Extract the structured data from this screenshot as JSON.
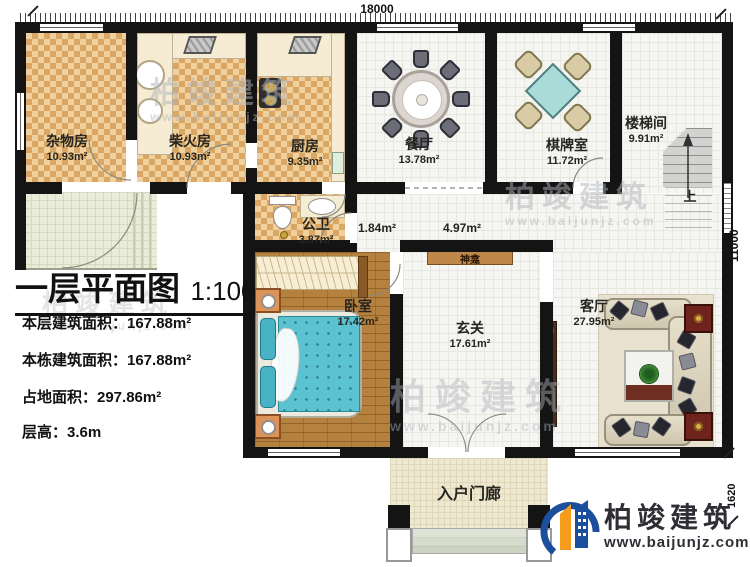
{
  "title_block": {
    "title": "一层平面图",
    "scale": "1:100",
    "line1": "本层建筑面积：167.88m²",
    "line2": "本栋建筑面积：167.88m²",
    "line3": "占地面积：297.86m²",
    "line4": "层高：3.6m"
  },
  "dimensions": {
    "top": "18000",
    "right": "11000",
    "porch": "1620"
  },
  "rooms": {
    "storage": {
      "name": "杂物房",
      "area": "10.93m²"
    },
    "firewood": {
      "name": "柴火房",
      "area": "10.93m²"
    },
    "kitchen": {
      "name": "厨房",
      "area": "9.35m²"
    },
    "dining": {
      "name": "餐厅",
      "area": "13.78m²"
    },
    "chess": {
      "name": "棋牌室",
      "area": "11.72m²"
    },
    "stairwell": {
      "name": "楼梯间",
      "area": "9.91m²"
    },
    "bathroom": {
      "name": "公卫",
      "area": "3.87m²"
    },
    "bedroom": {
      "name": "卧室",
      "area": "17.42m²"
    },
    "foyer": {
      "name": "玄关",
      "area": "17.61m²"
    },
    "living": {
      "name": "客厅",
      "area": "27.95m²"
    },
    "porch": {
      "name": "入户门廊"
    }
  },
  "hall_areas": {
    "left": "1.84m²",
    "right": "4.97m²"
  },
  "annotations": {
    "shrine": "神龛",
    "stairs_up": "上"
  },
  "brand": {
    "name": "柏竣建筑",
    "url": "www.baijunjz.com"
  },
  "colors": {
    "logo_blue": "#1b4f9e",
    "logo_orange": "#f59c1c",
    "checker": "#d9a763",
    "wall": "#141414"
  }
}
